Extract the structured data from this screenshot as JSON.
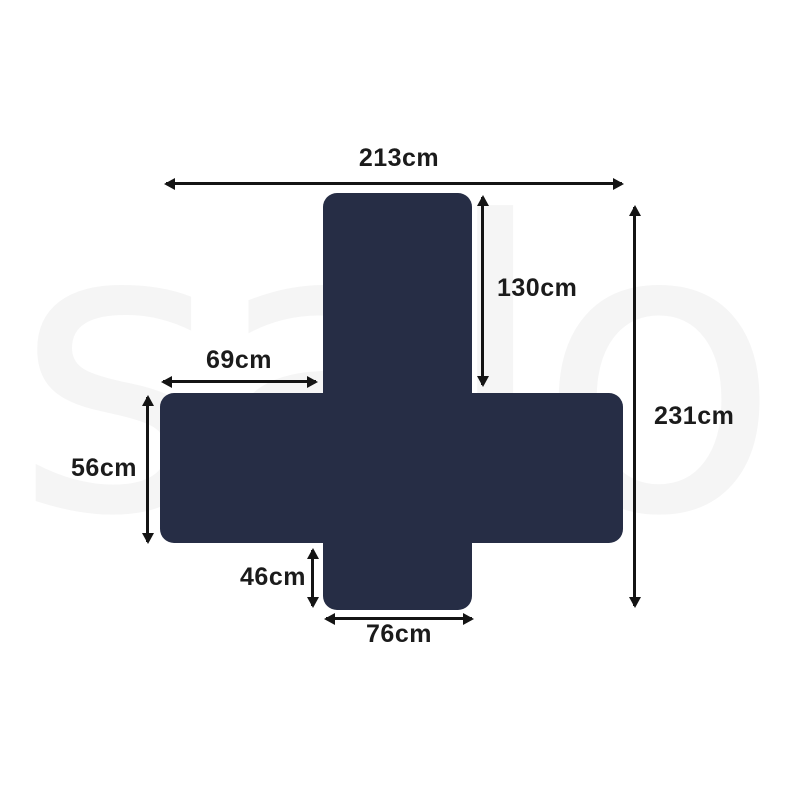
{
  "watermark": {
    "text": "salo",
    "color": "#f5f5f5"
  },
  "shape": {
    "name": "couch-cover-silhouette",
    "color": "#262d45"
  },
  "arrow_color": "#141414",
  "dimensions": {
    "top_width": "213cm",
    "back_panel_height": "130cm",
    "left_arm_width": "69cm",
    "overall_length": "231cm",
    "side_panel_height": "56cm",
    "front_flap_height": "46cm",
    "front_flap_width": "76cm"
  }
}
